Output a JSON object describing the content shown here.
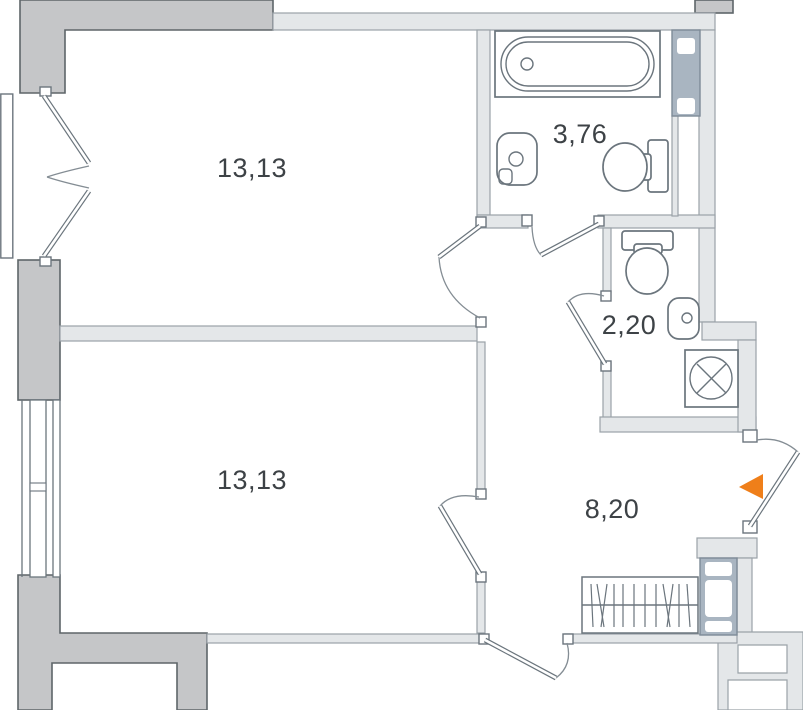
{
  "plan": {
    "kind": "apartment-floor-plan",
    "labels": {
      "room1_area": "13,13",
      "room2_area": "13,13",
      "bathroom_area": "3,76",
      "wc_area": "2,20",
      "hallway_area": "8,20"
    },
    "fixtures": [
      "bathtub",
      "bathroom-sink",
      "bathroom-toilet",
      "wc-toilet",
      "wc-sink",
      "washing-machine",
      "wardrobe",
      "ventilation-shaft",
      "window",
      "balcony-door",
      "entrance-door"
    ],
    "colors": {
      "entrance_marker": "#ef7f1a",
      "wall_structural": "#c5c6c8",
      "wall_partition": "#e4e7e9",
      "shaft_fill": "#a9b5c1",
      "line": "#6b757d",
      "text": "#3d4246"
    }
  }
}
